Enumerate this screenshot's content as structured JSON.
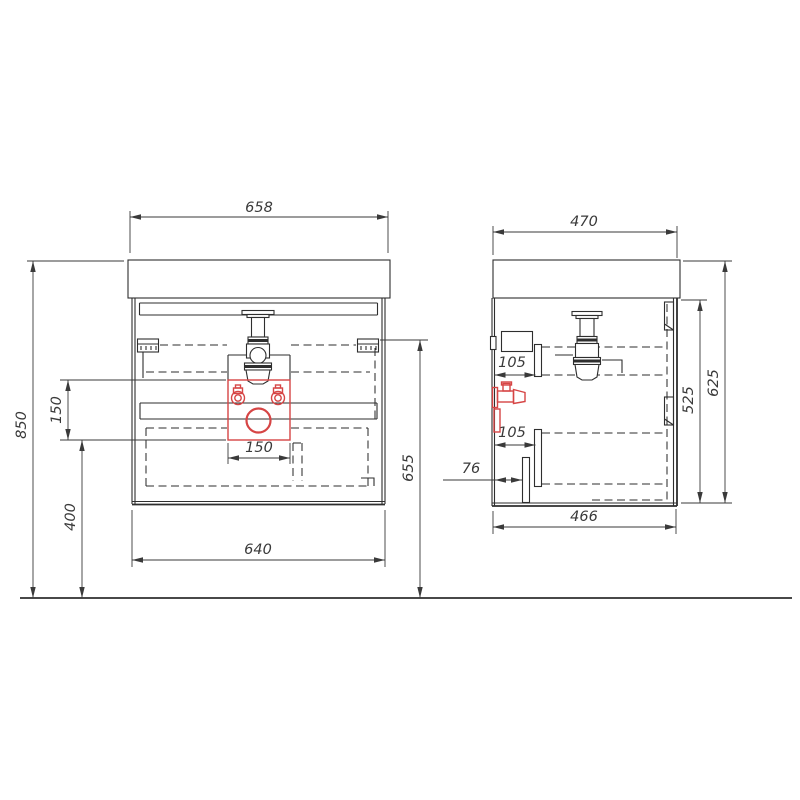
{
  "dimensions": {
    "front": {
      "top_width": "658",
      "body_width": "640",
      "connection_box_width": "150",
      "overall_height": "850",
      "connection_zone_height": "150",
      "connection_zone_floor_offset": "400",
      "drawer_slide_height": "655"
    },
    "side": {
      "top_depth": "470",
      "body_depth": "466",
      "carcass_height": "525",
      "overall_side_height": "625",
      "upper_slide_offset": "105",
      "lower_slide_offset": "105",
      "bottom_clearance": "76"
    }
  },
  "colors": {
    "line": "#2e2e2e",
    "dimension": "#3a3a3a",
    "accent_red": "#d64545",
    "background": "#ffffff"
  }
}
